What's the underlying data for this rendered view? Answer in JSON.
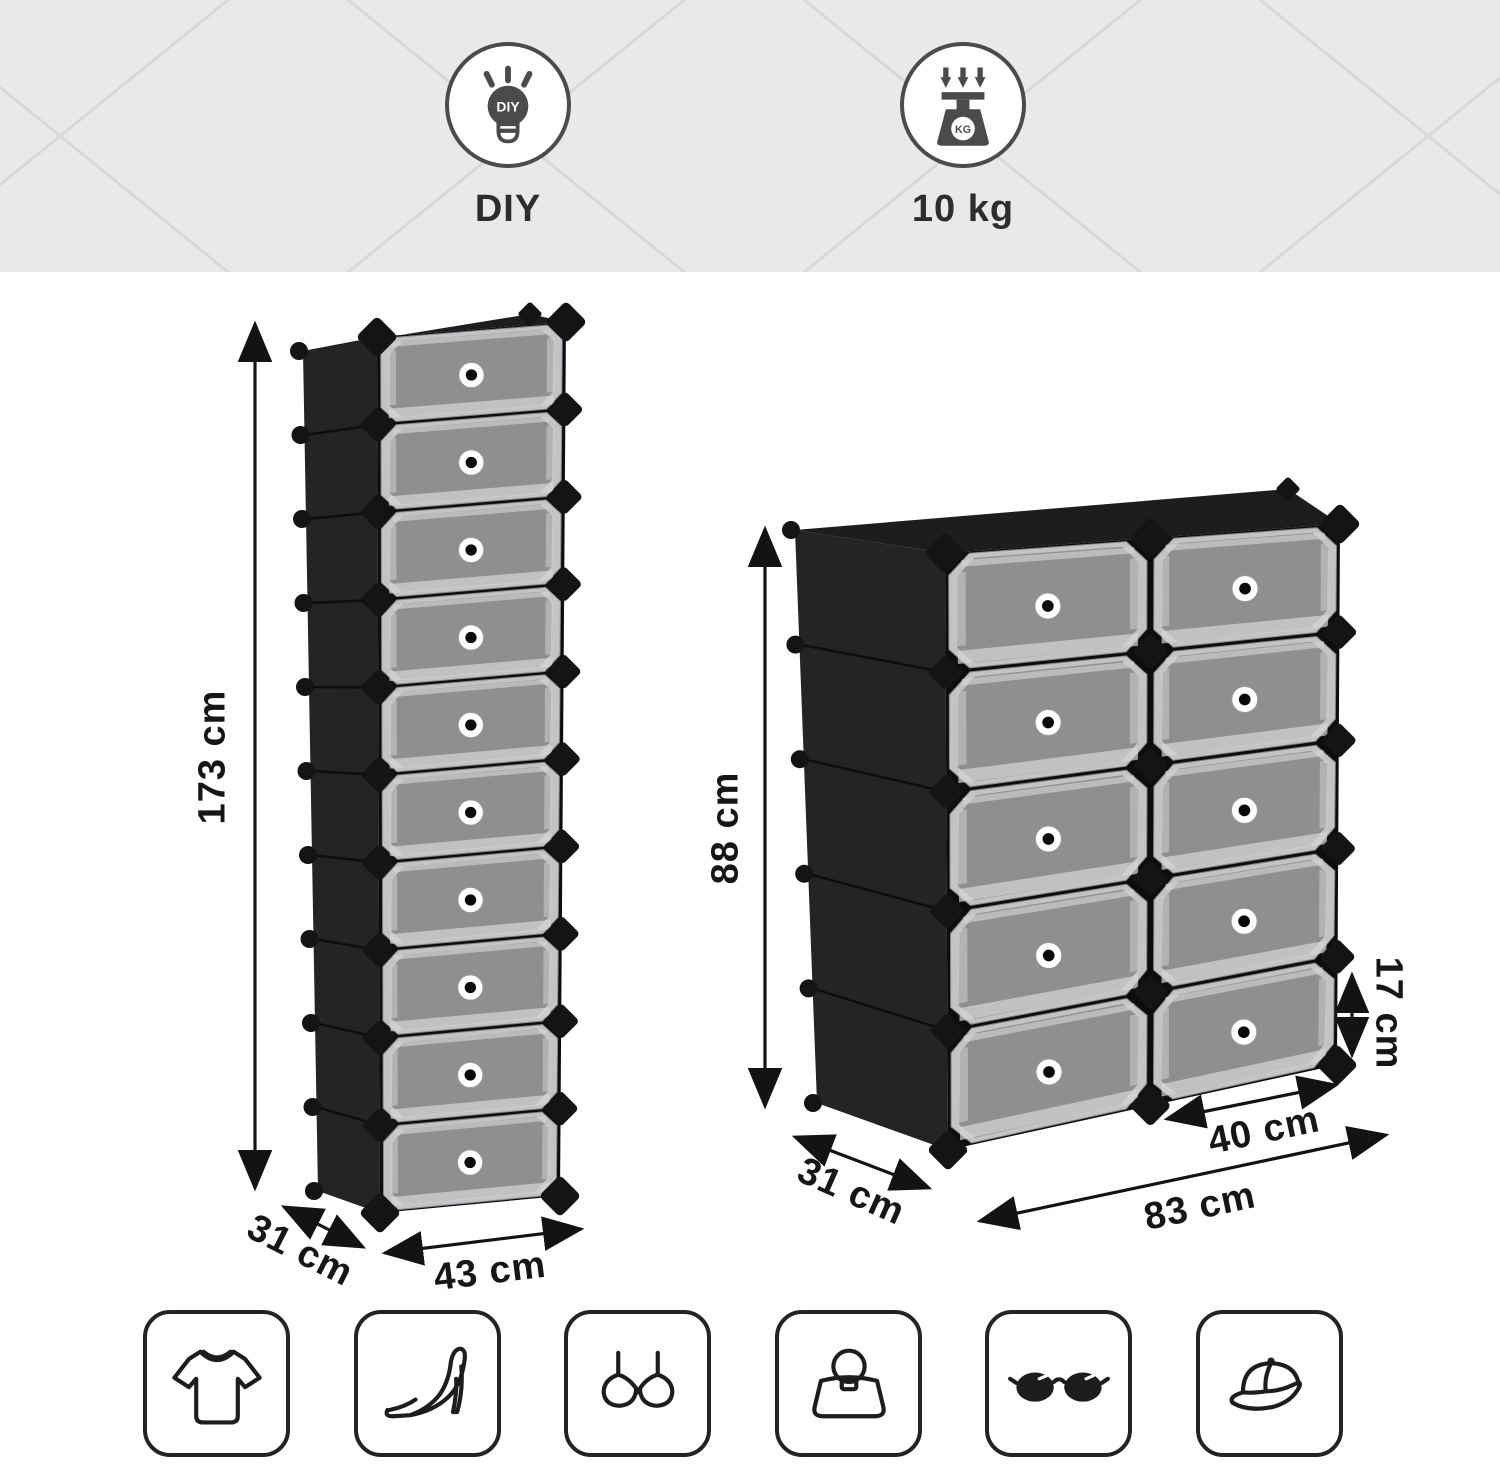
{
  "banner": {
    "badges": [
      {
        "id": "diy",
        "label": "DIY",
        "icon": "diy-lightbulb-icon",
        "icon_text": "DIY"
      },
      {
        "id": "max-load",
        "label": "10 kg",
        "icon": "weight-scale-icon",
        "icon_text": "KG"
      }
    ]
  },
  "product": {
    "units": [
      {
        "id": "tall-unit",
        "compartments": 10,
        "rows": 10,
        "columns": 1
      },
      {
        "id": "wide-unit",
        "compartments": 10,
        "rows": 5,
        "columns": 2
      }
    ],
    "colors": {
      "frame_black": "#1a1a1c",
      "door_gray": "#8f8f91",
      "door_frame": "#c3c3c5"
    }
  },
  "dimension_labels": [
    {
      "id": "tall-unit-height",
      "text": "173 cm"
    },
    {
      "id": "tall-unit-depth",
      "text": "31 cm"
    },
    {
      "id": "tall-unit-width",
      "text": "43 cm"
    },
    {
      "id": "wide-unit-height",
      "text": "88 cm"
    },
    {
      "id": "wide-unit-depth",
      "text": "31 cm"
    },
    {
      "id": "wide-unit-width",
      "text": "83 cm"
    },
    {
      "id": "compartment-width",
      "text": "40 cm"
    },
    {
      "id": "compartment-height",
      "text": "17 cm"
    }
  ],
  "category_icons": [
    {
      "name": "t-shirt"
    },
    {
      "name": "high-heel"
    },
    {
      "name": "bra"
    },
    {
      "name": "handbag"
    },
    {
      "name": "sunglasses"
    },
    {
      "name": "baseball-cap"
    }
  ]
}
